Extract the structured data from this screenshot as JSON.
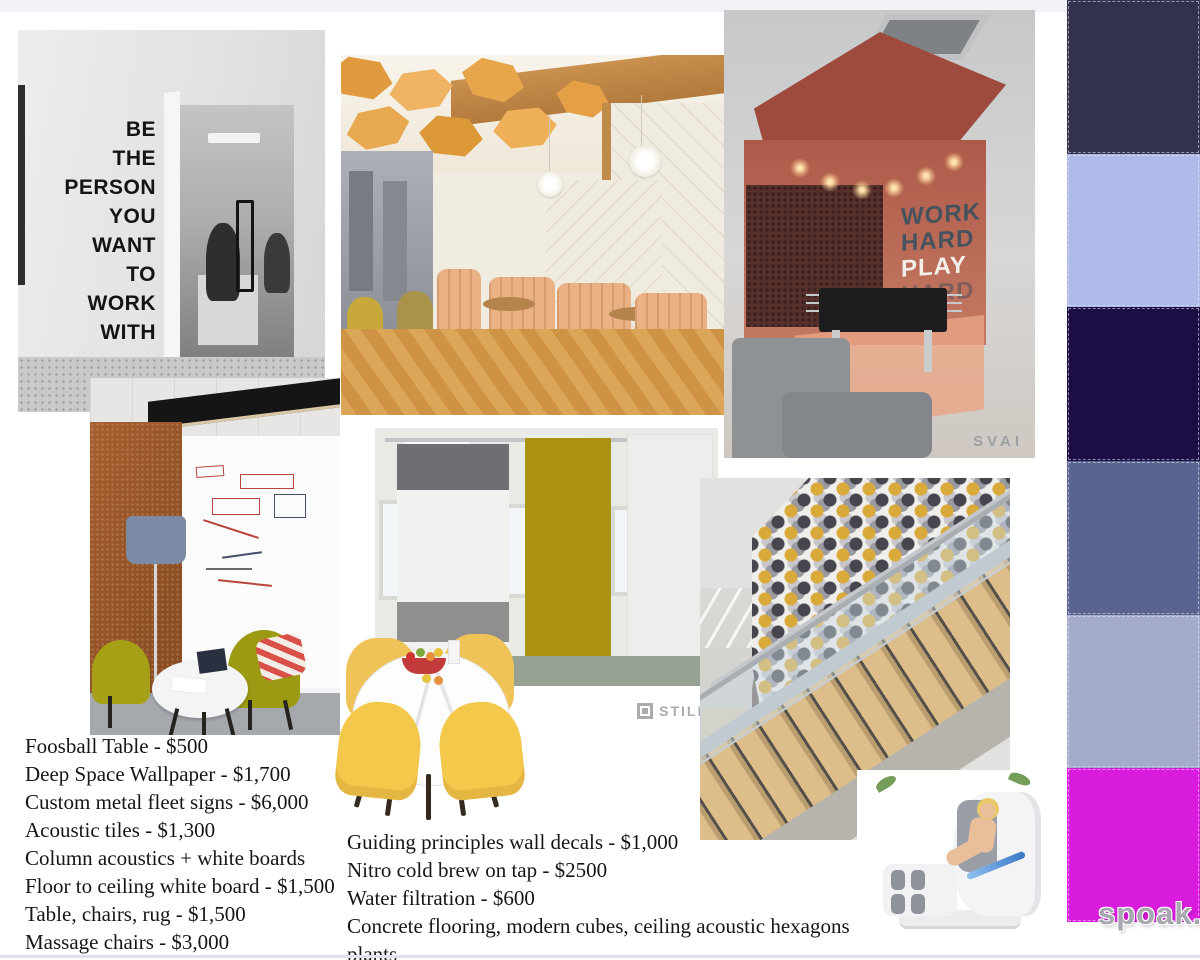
{
  "wall_decal": {
    "lines": [
      "BE",
      "THE",
      "PERSON",
      "YOU",
      "WANT",
      "TO",
      "WORK",
      "WITH"
    ]
  },
  "game_room": {
    "words": [
      "WORK",
      "HARD",
      "PLAY",
      "HARD"
    ],
    "watermark": "SVAI"
  },
  "acoustic_panels": {
    "watermark": "STILL"
  },
  "price_list_left": {
    "items": [
      "Foosball Table - $500",
      "Deep Space Wallpaper - $1,700",
      "Custom metal fleet signs - $6,000",
      "Acoustic tiles - $1,300",
      "Column acoustics + white boards",
      "Floor to ceiling white board - $1,500",
      "Table, chairs, rug - $1,500",
      "Massage chairs - $3,000"
    ]
  },
  "price_list_bottom": {
    "items": [
      "Guiding principles wall decals - $1,000",
      "Nitro cold brew on tap - $2500",
      "Water filtration - $600",
      "Concrete flooring, modern cubes, ceiling acoustic hexagons",
      "plants"
    ]
  },
  "palette": {
    "swatches": [
      {
        "name": "dark-navy",
        "color": "#32324E"
      },
      {
        "name": "periwinkle",
        "color": "#AEBAE8"
      },
      {
        "name": "deep-indigo",
        "color": "#1D0D45"
      },
      {
        "name": "slate-blue",
        "color": "#5A6491"
      },
      {
        "name": "lavender-gray",
        "color": "#A4ABCB"
      },
      {
        "name": "magenta",
        "color": "#D81BDC"
      }
    ]
  },
  "brand": {
    "watermark": "spoak."
  }
}
